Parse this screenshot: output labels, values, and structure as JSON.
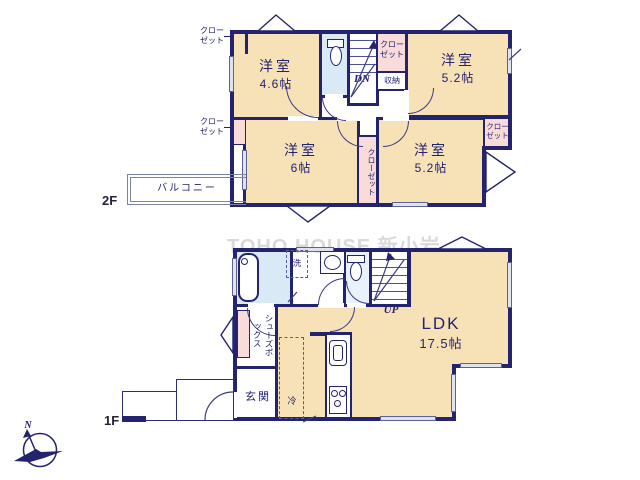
{
  "watermark": "TOHO HOUSE 新小岩",
  "labels": {
    "closet": "クローゼット",
    "storage": "収納",
    "balcony": "バルコニー",
    "stairs_down": "DN",
    "stairs_up": "UP",
    "entrance": "玄関",
    "shoe_box": "シューズボックス",
    "washer": "洗",
    "fridge": "冷",
    "north": "N"
  },
  "floor2": {
    "label": "2F",
    "rooms": {
      "bedroom_a": {
        "name": "洋室",
        "size": "4.6帖"
      },
      "bedroom_b": {
        "name": "洋室",
        "size": "5.2帖"
      },
      "bedroom_c": {
        "name": "洋室",
        "size": "6帖"
      },
      "bedroom_d": {
        "name": "洋室",
        "size": "5.2帖"
      }
    }
  },
  "floor1": {
    "label": "1F",
    "ldk": {
      "name": "LDK",
      "size": "17.5帖"
    }
  }
}
